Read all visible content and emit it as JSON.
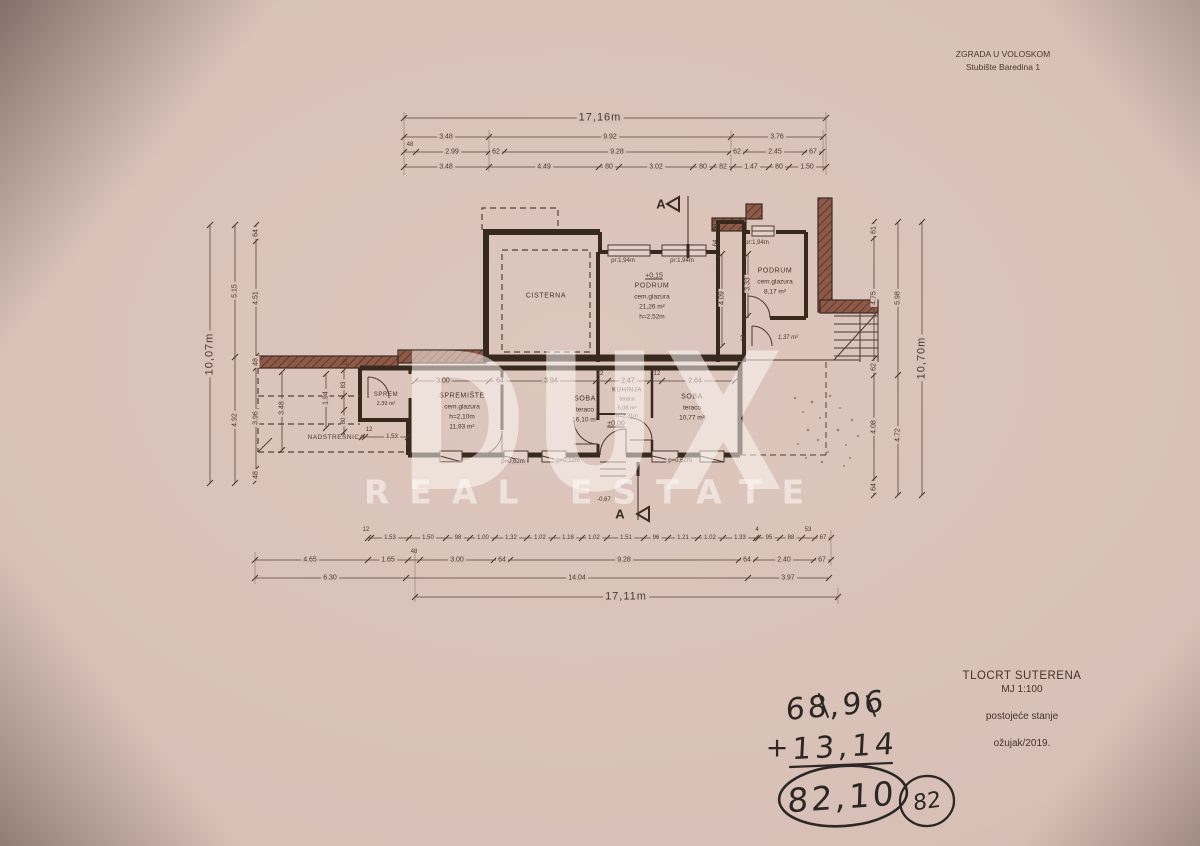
{
  "header": {
    "line1": "ZGRADA U VOLOSKOM",
    "line2": "Stubište Baredina 1"
  },
  "title_block": {
    "line1": "TLOCRT SUTERENA",
    "line2": "MJ 1:100",
    "line3": "postojeće stanje",
    "line4": "ožujak/2019."
  },
  "watermark": {
    "brand": "DUX",
    "tagline": "REAL ESTATE"
  },
  "section": {
    "label": "A"
  },
  "rooms": {
    "cisterna": {
      "name": "CISTERNA"
    },
    "podrum_main": {
      "name": "PODRUM",
      "finish": "cem.glazura",
      "area": "21,26 m²",
      "height": "h=2,52m"
    },
    "podrum_small": {
      "name": "PODRUM",
      "finish": "cem.glazura",
      "area": "8,17 m²"
    },
    "sprem": {
      "name": "SPREM",
      "area": "2,39 m²"
    },
    "spremiste": {
      "name": "SPREMIŠTE",
      "finish": "cem.glazura",
      "height": "h=2,10m",
      "area": "11,93 m²"
    },
    "soba_left": {
      "name": "SOBA",
      "finish": "teraco",
      "area": "16,10 m²"
    },
    "kuhinja": {
      "name": "KUHINJA",
      "finish": "teraco",
      "area": "5,08 m²",
      "height": "h=2,31m"
    },
    "soba_right": {
      "name": "SOBA",
      "finish": "teraco",
      "area": "10,77 m²"
    },
    "nadstresnica": {
      "name": "NADSTREŠNICA"
    },
    "hall": {
      "area": "1,37 m²"
    }
  },
  "levels": {
    "upper": "+0,15",
    "ground": "±0,00",
    "entry": "-0,67"
  },
  "openings": {
    "pr1": "pr:1,94m",
    "pr2": "pr:1,94m",
    "pr3": "pr:1,94m",
    "p1": "p=0,62m",
    "p2": "p=0,12m",
    "p3": "p=0,62m"
  },
  "dims": {
    "top": {
      "total": "17,16m",
      "r2": [
        "3.48",
        "9.92",
        "3.76"
      ],
      "r3": [
        "48",
        "2.99",
        "62",
        "9.28",
        "62",
        "2.45",
        "67"
      ],
      "r4": [
        "3.48",
        "4.49",
        "80",
        "3.02",
        "80",
        "82",
        "1.47",
        "80",
        "1.50"
      ]
    },
    "left": {
      "total": "10,07m",
      "mid": [
        "5.15",
        "4.92"
      ],
      "inner": [
        "64",
        "4.51",
        "48",
        "3.96",
        "48"
      ]
    },
    "right": {
      "total": "10,70m",
      "mid": [
        "5.98",
        "4.72"
      ],
      "inner": [
        "61",
        "4.75",
        "62",
        "4.08",
        "64"
      ]
    },
    "bottom": {
      "r1": [
        "12",
        "1.53",
        "1.50",
        "98",
        "1.00",
        "1.32",
        "1.02",
        "1.18",
        "1.02",
        "1.51",
        "96",
        "1.21",
        "1.02",
        "1.33",
        "4",
        "95",
        "88",
        "53",
        "67"
      ],
      "r2": [
        "4.65",
        "1.65",
        "48",
        "3.00",
        "64",
        "9.28",
        "64",
        "2.40",
        "67"
      ],
      "r3": [
        "6.30",
        "14.04",
        "3.97"
      ],
      "total": "17,11m"
    },
    "interior": [
      "3.00",
      "64",
      "3.94",
      "12",
      "2.47",
      "12",
      "2.64"
    ],
    "interior_v": [
      "3.48",
      "1.94",
      "83",
      "80",
      "26",
      "4.09",
      "3.33",
      "64",
      "63",
      "12"
    ],
    "nad": [
      "12",
      "1,53"
    ]
  },
  "handwriting": {
    "top": "68,96",
    "operator": "+",
    "middle": "13,14",
    "result": "82,10",
    "badge": "82"
  }
}
